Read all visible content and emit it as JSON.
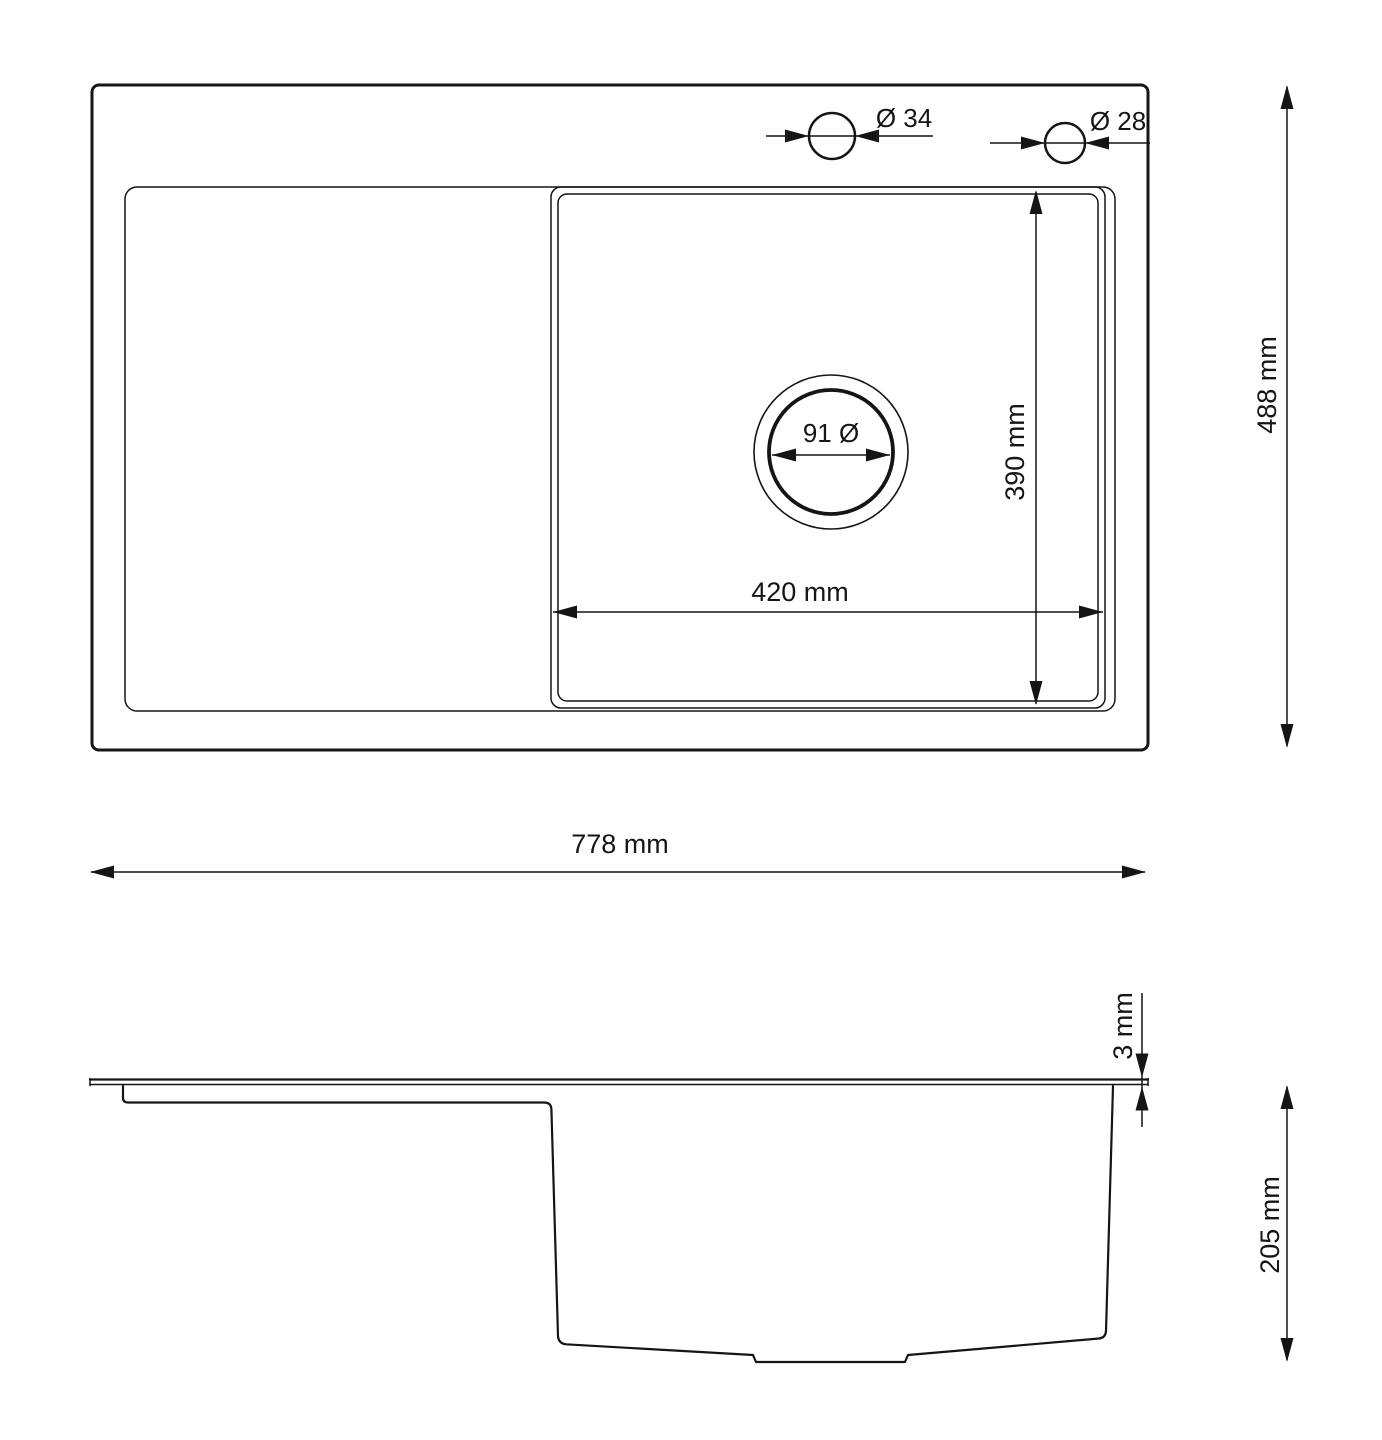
{
  "colors": {
    "background": "#ffffff",
    "line": "#151515"
  },
  "top_view": {
    "faucet_hole_large_label": "Ø 34",
    "faucet_hole_small_label": "Ø 28",
    "drain_label": "91 Ø",
    "bowl_width_label": "420 mm",
    "bowl_depth_label": "390 mm",
    "overall_depth_label": "488 mm"
  },
  "overall_width_label": "778 mm",
  "side_view": {
    "thickness_label": "3 mm",
    "bowl_height_label": "205 mm"
  },
  "dimensions_mm": {
    "overall_width": 778,
    "overall_depth": 488,
    "bowl_width": 420,
    "bowl_depth": 390,
    "bowl_height": 205,
    "top_plate_thickness": 3,
    "drain_diameter": 91,
    "faucet_hole_large_diameter": 34,
    "faucet_hole_small_diameter": 28
  }
}
